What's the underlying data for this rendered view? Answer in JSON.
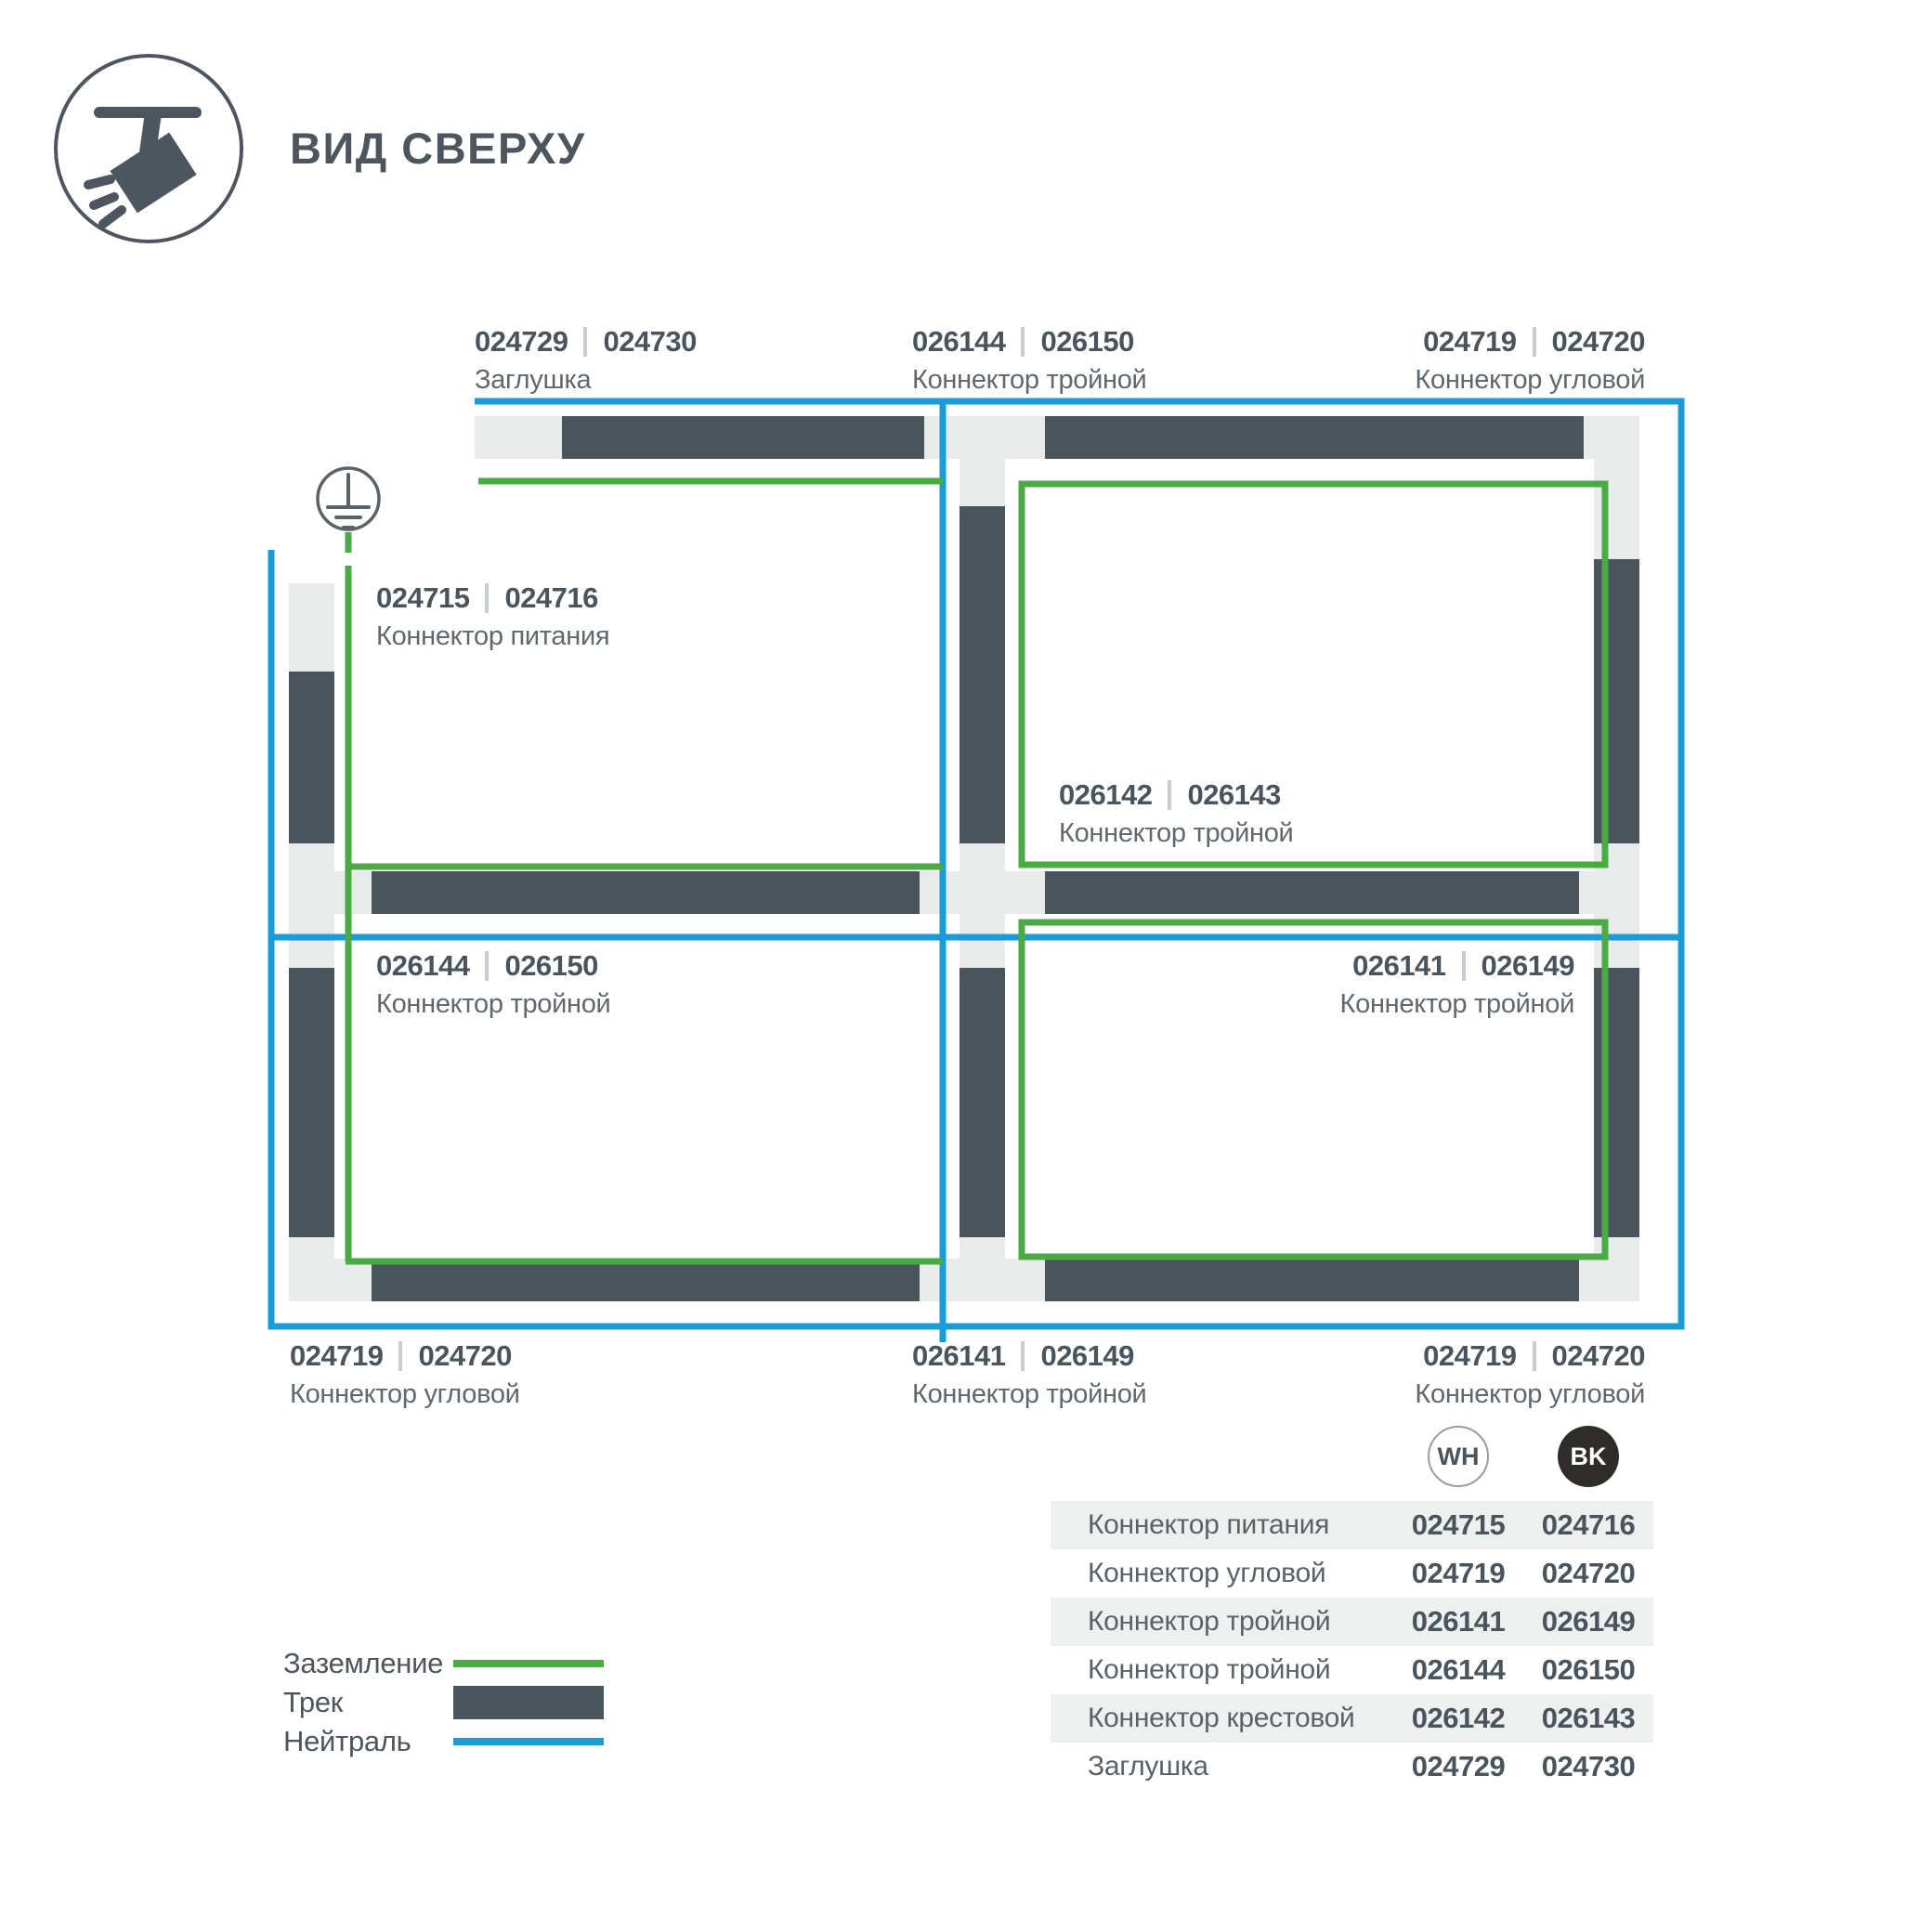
{
  "header": {
    "title": "ВИД СВЕРХУ"
  },
  "diagram": {
    "labels": {
      "top_left": {
        "code_wh": "024729",
        "code_bk": "024730",
        "name": "Заглушка"
      },
      "top_center": {
        "code_wh": "026144",
        "code_bk": "026150",
        "name": "Коннектор тройной"
      },
      "top_right": {
        "code_wh": "024719",
        "code_bk": "024720",
        "name": "Коннектор угловой"
      },
      "power": {
        "code_wh": "024715",
        "code_bk": "024716",
        "name": "Коннектор питания"
      },
      "center_cross": {
        "code_wh": "026142",
        "code_bk": "026143",
        "name": "Коннектор тройной"
      },
      "mid_left": {
        "code_wh": "026144",
        "code_bk": "026150",
        "name": "Коннектор тройной"
      },
      "mid_right": {
        "code_wh": "026141",
        "code_bk": "026149",
        "name": "Коннектор тройной"
      },
      "bottom_left": {
        "code_wh": "024719",
        "code_bk": "024720",
        "name": "Коннектор угловой"
      },
      "bottom_center": {
        "code_wh": "026141",
        "code_bk": "026149",
        "name": "Коннектор тройной"
      },
      "bottom_right": {
        "code_wh": "024719",
        "code_bk": "024720",
        "name": "Коннектор угловой"
      }
    }
  },
  "legend": {
    "items": [
      {
        "label": "Заземление"
      },
      {
        "label": "Трек"
      },
      {
        "label": "Нейтраль"
      }
    ]
  },
  "table": {
    "columns": {
      "wh": "WH",
      "bk": "BK"
    },
    "rows": [
      {
        "name": "Коннектор питания",
        "wh": "024715",
        "bk": "024716"
      },
      {
        "name": "Коннектор угловой",
        "wh": "024719",
        "bk": "024720"
      },
      {
        "name": "Коннектор тройной",
        "wh": "026141",
        "bk": "026149"
      },
      {
        "name": "Коннектор тройной",
        "wh": "026144",
        "bk": "026150"
      },
      {
        "name": "Коннектор крестовой",
        "wh": "026142",
        "bk": "026143"
      },
      {
        "name": "Заглушка",
        "wh": "024729",
        "bk": "024730"
      }
    ]
  },
  "colors": {
    "track": "#4a545c",
    "connector": "#e9ebeb",
    "ground_green": "#4aaa44",
    "neutral_blue": "#1a9cd8",
    "title_text": "#4d565e",
    "muted_text": "#60676d",
    "bk_badge": "#2e2d2a",
    "row_shade": "#eef0f0"
  }
}
